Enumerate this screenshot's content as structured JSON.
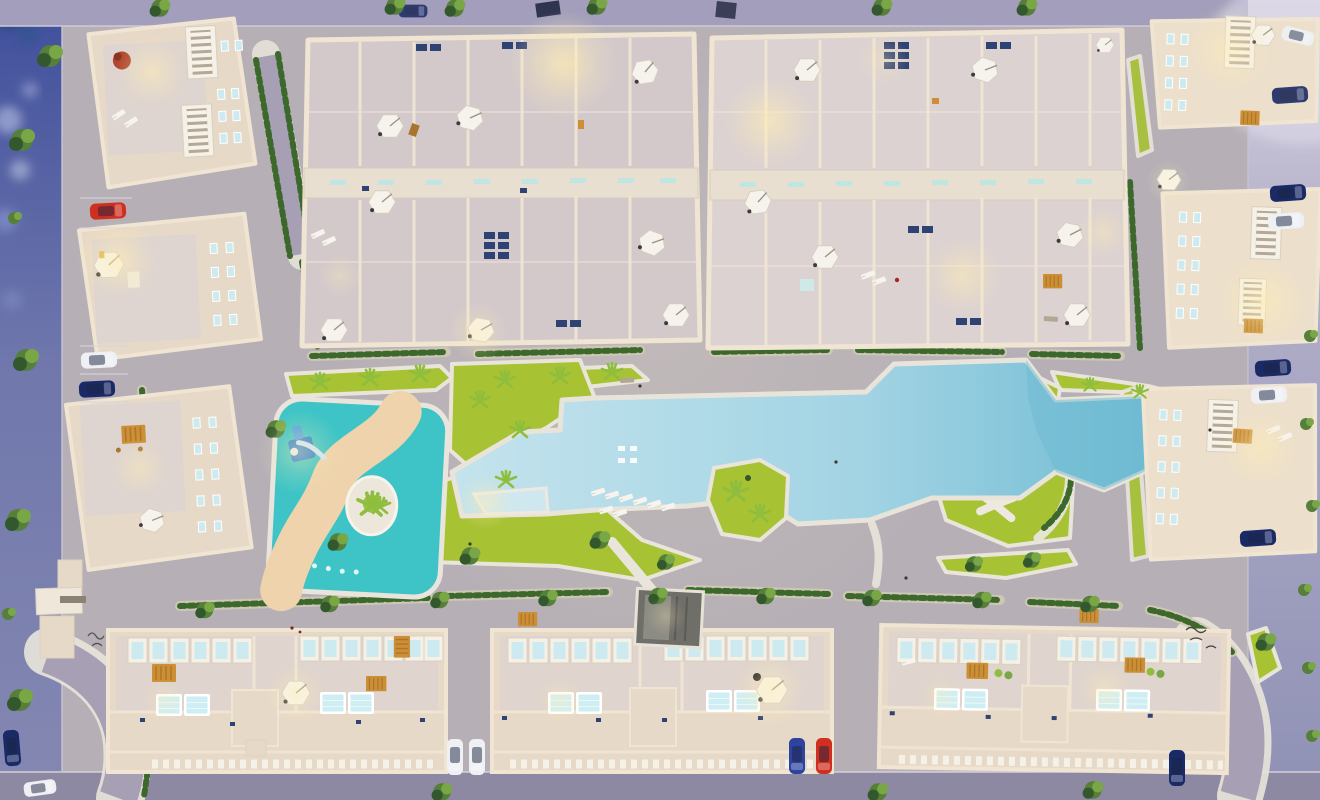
{
  "scene": {
    "description": "Top-down aerial 3D render at dusk of a residential complex: two roof-plan townhouse blocks at the top, apartment buildings around the perimeter, and a central leisure courtyard with a free-form pool, children's lagoon, lawns and playground",
    "time_of_day": "dusk",
    "view": "top-down aerial render",
    "has_text": false
  },
  "areas": {
    "main_pool": "Free-form communal swimming pool with in-water steps, palm island and sun loungers",
    "wedge_pool": "Small wedge-shaped lap pool",
    "kids_pool": "Children's turquoise lagoon with winding sand path, palm island and blue water slide",
    "playground": "Lawn playground with white branching paths and hedge-lined walk",
    "lawns": "Lime-green landscaped lawns with palm trees",
    "promenade": "Pedestrian promenade with hedges and street trees",
    "townhouse_blocks": "Two townhouse blocks seen as roof plans with terrace umbrellas, skylights and lit courtyards",
    "perimeter_buildings": "Apartment buildings with rooftop terraces, white stair wells, pergolas and plunge pools",
    "streets": "Perimeter streets with parallel-parked cars, sidewalks and trees",
    "entrance": "Gated entrance structures and cobbled drive at the south-west corner",
    "entrance_stair": "Dark stair entrance from promenade to garage"
  },
  "objects": {
    "umbrella_count": 21,
    "rooftop_pool_count": 12,
    "stair_well_count": 6,
    "cars": [
      {
        "color": "red",
        "location": "west-driveway"
      },
      {
        "color": "white",
        "location": "west-driveway"
      },
      {
        "color": "navy",
        "location": "west-driveway"
      },
      {
        "color": "navy",
        "location": "east-street-top"
      },
      {
        "color": "navy",
        "location": "east-street"
      },
      {
        "color": "white",
        "location": "east-street"
      },
      {
        "color": "navy",
        "location": "east-street"
      },
      {
        "color": "white",
        "location": "east-street"
      },
      {
        "color": "navy",
        "location": "east-street"
      },
      {
        "color": "white",
        "location": "south-gap-west"
      },
      {
        "color": "white",
        "location": "south-gap-west"
      },
      {
        "color": "blue",
        "location": "south-gap-east"
      },
      {
        "color": "red",
        "location": "south-gap-east"
      },
      {
        "color": "navy",
        "location": "south-east-corner"
      },
      {
        "color": "white",
        "location": "south-road"
      },
      {
        "color": "navy",
        "location": "west-street"
      }
    ]
  },
  "colors": {
    "courtyard": "#b6b0b6",
    "concrete_light": "#c6c0c4",
    "path_white": "#e9e5da",
    "grass": "#a7c233",
    "grass_light": "#b6cf3d",
    "hedge_base": "#cec7b6",
    "hedge_green": "#3c682c",
    "tree": "#567f3a",
    "tree_dark": "#33582d",
    "tree_light": "#7aa746",
    "palm": "#8fbe3e",
    "pool_light": "#c4e3ed",
    "pool_mid": "#a3d4e4",
    "pool_deep": "#6cb9d1",
    "kids_water": "#3ec4c6",
    "sand": "#eed3ac",
    "island_sand": "#ece7da",
    "wall": "#e7d9c7",
    "wall_stroke": "#f0e5d2",
    "block_floor": "#d3c9cb",
    "corridor": "#e8dfd1",
    "terrace": "#dcd2d1",
    "facade": "#ecdfcc",
    "window_glass": "#cdeaf0",
    "window_frame": "#f6f1e7",
    "skylight_navy": "#2e4273",
    "skylight_teal": "#bfe6e2",
    "umbrella": "#f6f3ec",
    "umbrella_stroke": "#d5cec0",
    "pergola": "#cd8f35",
    "table_brown": "#a8742e",
    "roof_pool": "#cfeef4",
    "glow": "#ffedb4",
    "street_left_top": "#3f4f9c",
    "street_left_bot": "#8588b1",
    "street_right_top": "#d9d5e3",
    "street_right_bot": "#8f91b5",
    "sidewalk": "#a29ebb",
    "road": "#8e89a2",
    "cobble": "#a79fb3",
    "car_red": "#d02f1f",
    "car_blue": "#2e42a0",
    "car_navy": "#1a2a66",
    "car_white": "#eef0f4",
    "slide_blue": "#2f7fd0",
    "entrance_dark": "#6f6e68",
    "entrance_mid": "#8d8c84",
    "plant_red": "#b0482e",
    "bokeh": "#cdd7f2"
  }
}
